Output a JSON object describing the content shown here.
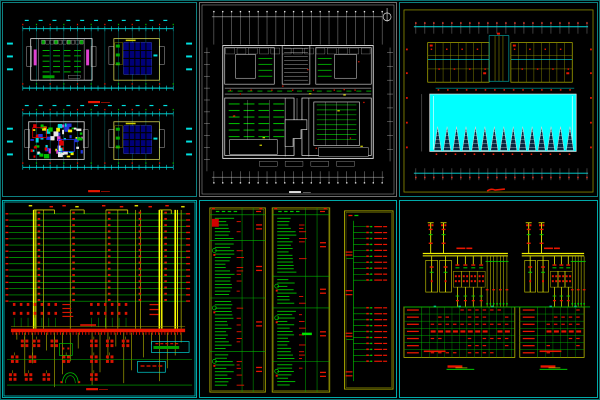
{
  "app": {
    "title": "CAD multi-sheet electrical drawing montage",
    "background": "#000000",
    "outer_frame": "#0b6f6f"
  },
  "palette": {
    "teal": "#0d8080",
    "cyan": "#00e0e0",
    "pool_cyan": "#00ffff",
    "green": "#00b400",
    "bright_green": "#00e800",
    "dim_green": "#0a9a9a",
    "red": "#e81600",
    "dark_red": "#c81000",
    "yellow": "#f2f200",
    "olive": "#9c9c00",
    "dark_olive": "#7f7f00",
    "white": "#e8e8e8",
    "gray": "#9e9e9e",
    "magenta": "#e040d0",
    "navy": "#000078",
    "blue": "#3344e0"
  },
  "sheets": {
    "top_left": {
      "name": "paired floor plans, two levels stacked",
      "dim_color": "#00e0e0",
      "title_color": "#e81600",
      "title_marks": 2,
      "levels": [
        {
          "left_block": "hatched plan with magenta accents",
          "right_block": "navy grid-panel plan"
        },
        {
          "left_block": "multicolor mosaic plan",
          "right_block": "navy grid-panel plan"
        }
      ],
      "grid_ticks": 22
    },
    "top_center": {
      "name": "overall detailed floor plan",
      "frame": "#8f8f8f",
      "ink": "#e8e8e8",
      "detail_green": "#00b400",
      "grid_ticks": 20,
      "north_arrow": true,
      "title_color": "#e0e0e0"
    },
    "top_right": {
      "name": "roof plan with cyan court and skylight row",
      "frame": "#8f8f00",
      "pool": "#00ffff",
      "skylights": 15,
      "dim_color": "#00e0e0",
      "dot_color": "#e81600",
      "title_color": "#e81600"
    },
    "bottom_left": {
      "name": "electrical riser diagram",
      "floors": 15,
      "floor_y0": 13,
      "floor_dy": 6.3,
      "floor_color": "#00b400",
      "bus_color": "#e81600",
      "risers": [
        31,
        41,
        68,
        104,
        116,
        134,
        139,
        158,
        161,
        174,
        180
      ],
      "bright_risers": [
        31,
        158,
        174
      ],
      "mark_columns": [
        35,
        70,
        106,
        137,
        163
      ],
      "title_color": "#e81600"
    },
    "bottom_center": {
      "name": "distribution panel schedules",
      "tables": 3,
      "frame": "#9c9c00",
      "rule_color": "#00b400",
      "text_color": "#e81600",
      "entry_color": "#00c800",
      "table_x": [
        10,
        73,
        146
      ],
      "table_w": [
        56,
        58,
        49
      ]
    },
    "bottom_right": {
      "name": "transformer one-line diagrams with schedules",
      "units": 2,
      "bus_color": "#f2f200",
      "frame": "#b9b900",
      "rule_color": "#00b400",
      "text_color": "#e81600",
      "title_color": "#e81600",
      "title_underline": "#00e800"
    }
  }
}
